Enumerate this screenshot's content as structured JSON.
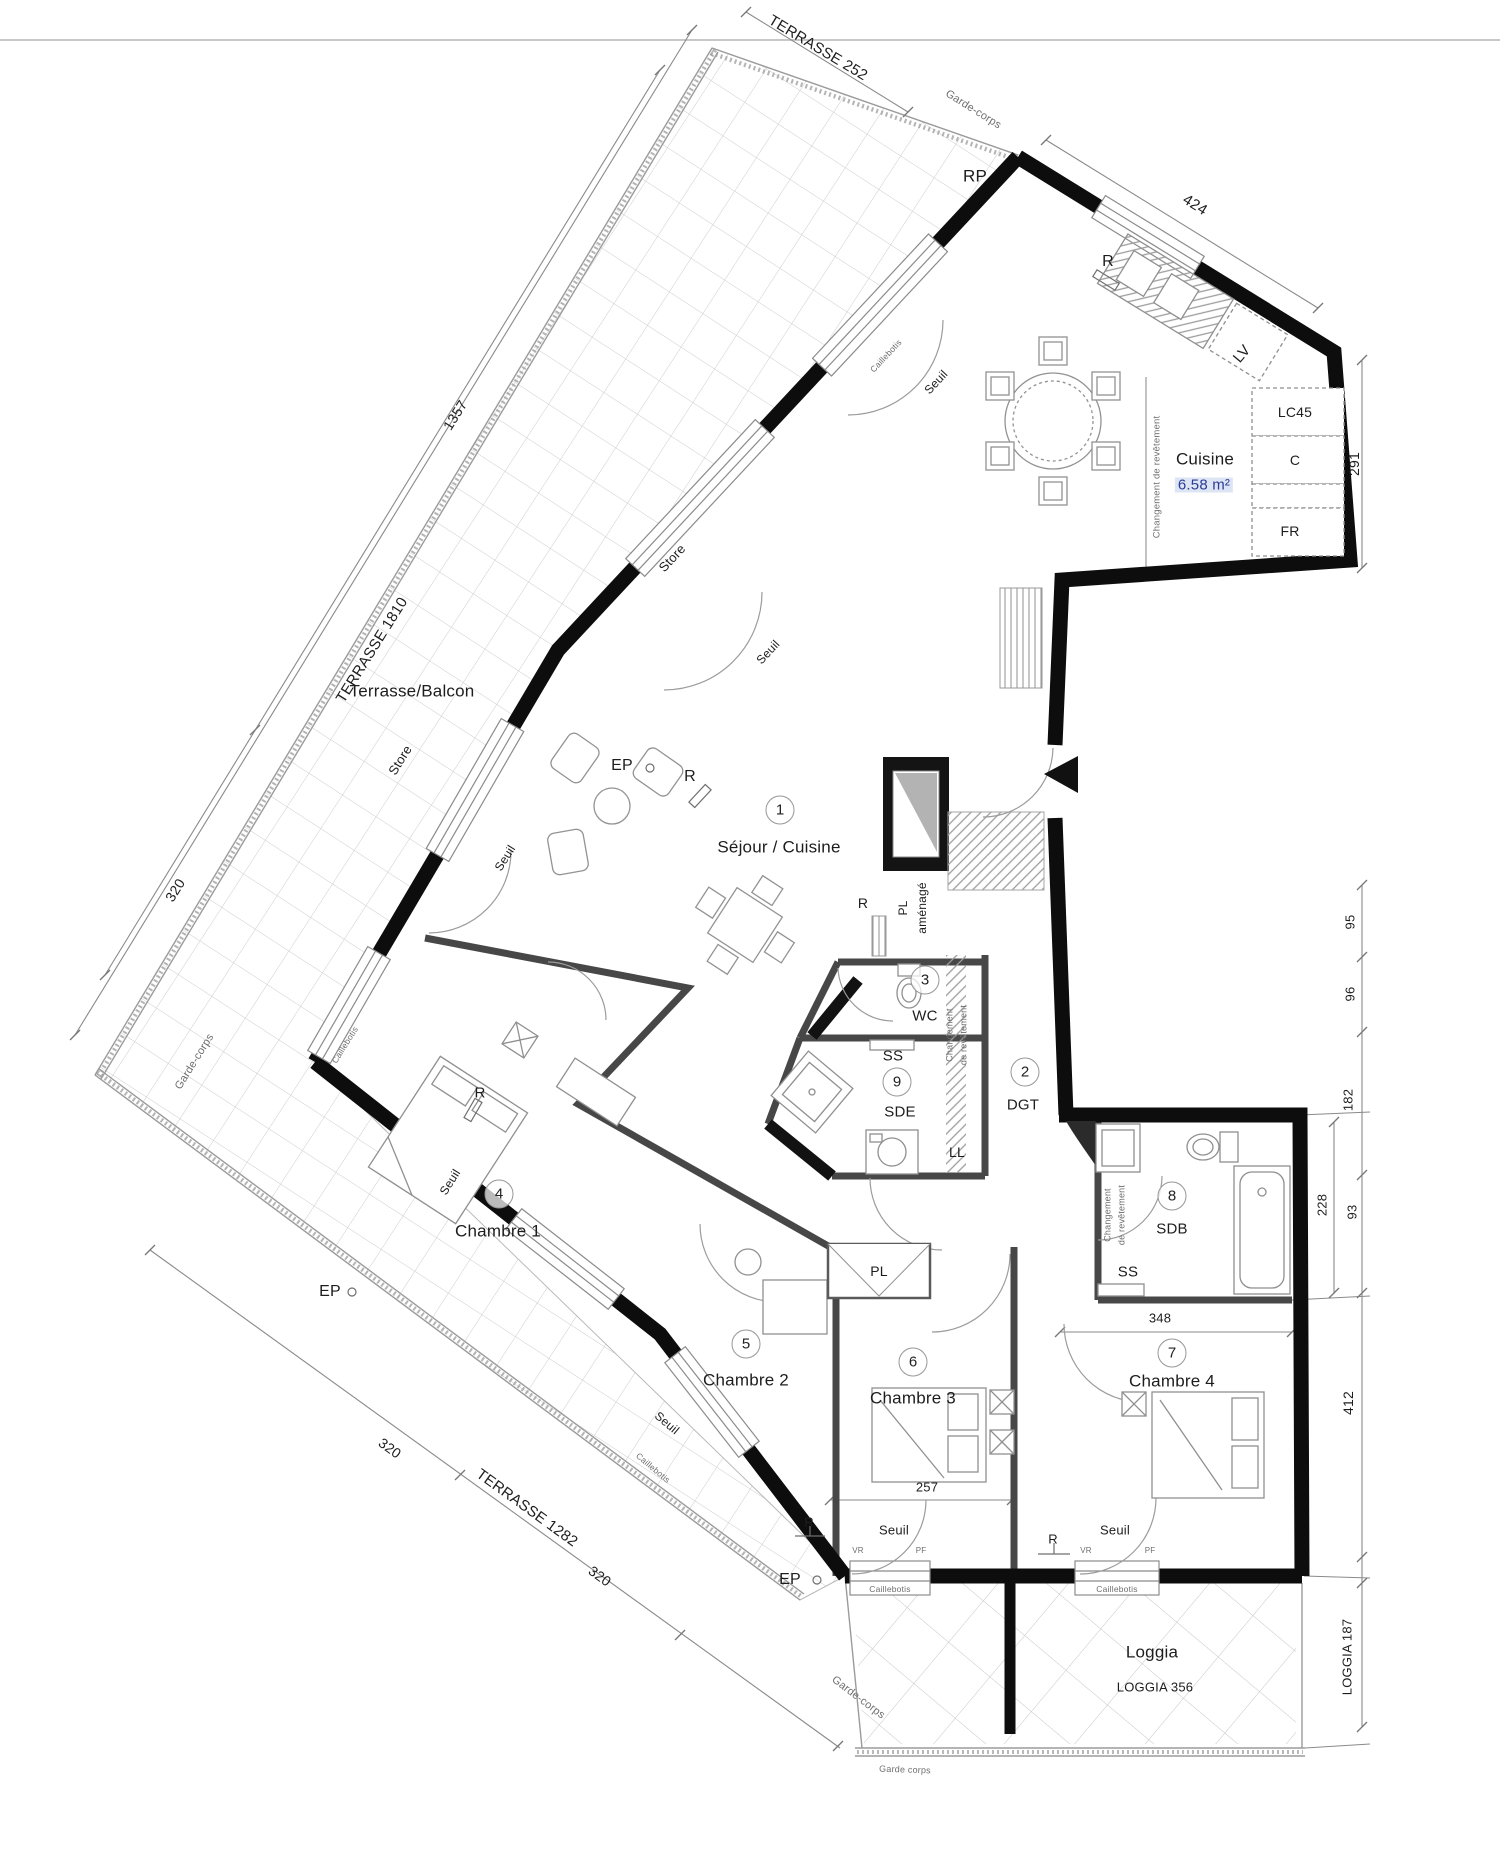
{
  "rooms": [
    {
      "num": "1",
      "name": "Séjour / Cuisine"
    },
    {
      "num": "2",
      "name": "DGT"
    },
    {
      "num": "3",
      "name": "WC"
    },
    {
      "num": "4",
      "name": "Chambre 1"
    },
    {
      "num": "5",
      "name": "Chambre 2"
    },
    {
      "num": "6",
      "name": "Chambre 3"
    },
    {
      "num": "7",
      "name": "Chambre 4"
    },
    {
      "num": "8",
      "name": "SDB"
    },
    {
      "num": "9",
      "name": "SDE"
    }
  ],
  "kitchen": {
    "label": "Cuisine",
    "area": "6.58 m²"
  },
  "areas": {
    "terrace": "Terrasse/Balcon",
    "loggia": "Loggia"
  },
  "dims": {
    "terrasse_252": "TERRASSE 252",
    "d424": "424",
    "d291": "291",
    "d1357": "1357",
    "terrasse_1810": "TERRASSE 1810",
    "d320": "320",
    "d95": "95",
    "d96": "96",
    "d182": "182",
    "d228": "228",
    "d93": "93",
    "d412": "412",
    "loggia_187": "LOGGIA 187",
    "d348": "348",
    "d257": "257",
    "terrasse_1282": "TERRASSE 1282",
    "loggia_356": "LOGGIA 356"
  },
  "ann": {
    "rp": "RP",
    "r": "R",
    "ep": "EP",
    "lv": "LV",
    "lc45": "LC45",
    "c": "C",
    "fr": "FR",
    "pl": "PL",
    "pl_amenage_line1": "PL",
    "pl_amenage_line2": "aménagé",
    "ss": "SS",
    "ll": "LL",
    "seuil": "Seuil",
    "store": "Store",
    "caillebotis": "Caillebotis",
    "garde_corps": "Garde-corps",
    "garde_corps_small": "Garde corps",
    "changement": "Changement",
    "de_revetement": "de revêtement",
    "changement_full": "Changement de revêtement",
    "vr": "VR",
    "pf": "PF"
  }
}
